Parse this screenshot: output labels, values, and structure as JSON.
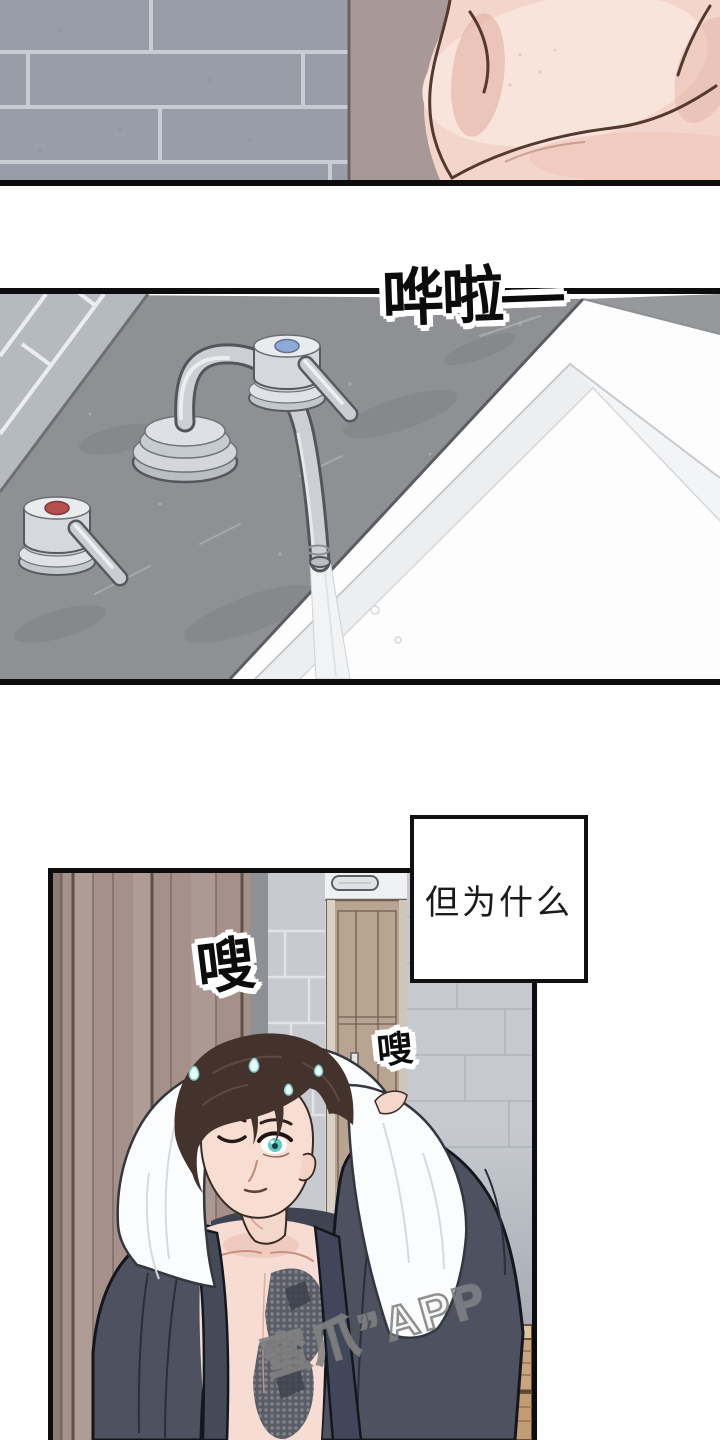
{
  "comic": {
    "sfx_water": "哗啦—",
    "sfx_swish_large": "嗖",
    "sfx_swish_small": "嗖",
    "speech_text": "但为什么",
    "watermark_text": "蜜爪”APP"
  },
  "colors": {
    "panel_border": "#0d0d0d",
    "hot_handle_red": "#b5504e",
    "cold_handle_blue": "#8fa9d9",
    "eye_teal": "#5fc9c3",
    "robe_navy": "#4d5160",
    "wood_wall_brown": "#a6918a",
    "counter_grey": "#8e9094",
    "skin_pink": "#f3d5cb"
  }
}
